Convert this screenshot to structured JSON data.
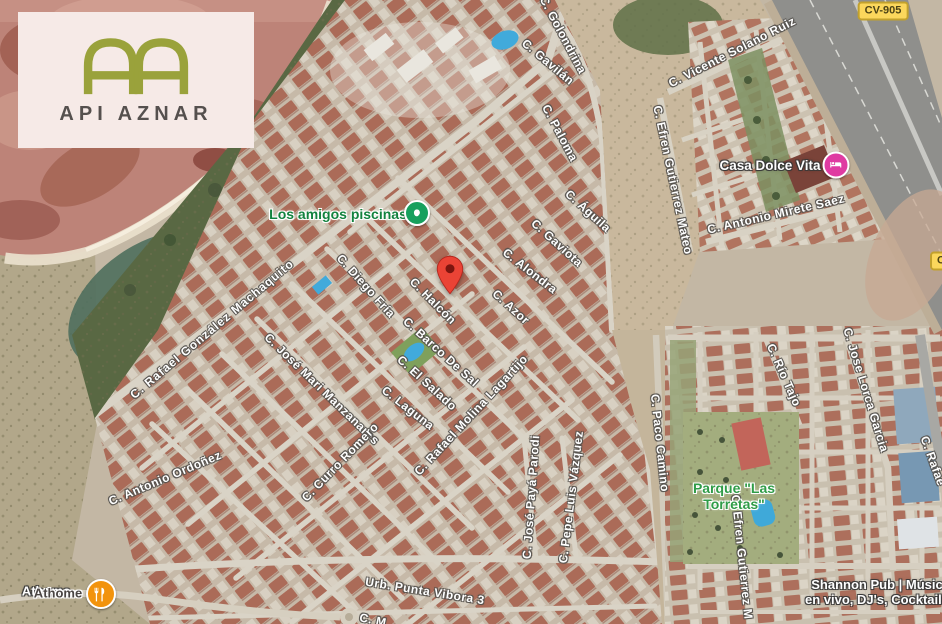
{
  "map_overlay": {
    "logo": {
      "monogram": "AA",
      "brand": "API AZNAR",
      "monogram_color": "#9aa23b",
      "card_color": "#f6eae7",
      "text_color": "#55504e"
    },
    "marker": {
      "name": "dropped-pin",
      "x": 450,
      "y": 296,
      "color": "#EA4335"
    },
    "road_badges": [
      {
        "label": "CV-905",
        "x": 883,
        "y": 11
      },
      {
        "label": "C",
        "x": 941,
        "y": 261
      }
    ],
    "street_labels": [
      {
        "label": "C. Golondrina",
        "x": 563,
        "y": 35,
        "rot": 62
      },
      {
        "label": "C. Gavilán",
        "x": 548,
        "y": 62,
        "rot": 40
      },
      {
        "label": "C. Paloma",
        "x": 560,
        "y": 133,
        "rot": 62
      },
      {
        "label": "C. Águila",
        "x": 588,
        "y": 211,
        "rot": 42
      },
      {
        "label": "C. Gaviota",
        "x": 557,
        "y": 243,
        "rot": 42
      },
      {
        "label": "C. Alondra",
        "x": 530,
        "y": 271,
        "rot": 38
      },
      {
        "label": "C. Azor",
        "x": 511,
        "y": 307,
        "rot": 42
      },
      {
        "label": "C. Halcón",
        "x": 433,
        "y": 301,
        "rot": 45
      },
      {
        "label": "C. Diego Fría",
        "x": 366,
        "y": 286,
        "rot": 48
      },
      {
        "label": "C. Barco De Sal",
        "x": 441,
        "y": 352,
        "rot": 42
      },
      {
        "label": "C. El Salado",
        "x": 427,
        "y": 383,
        "rot": 42
      },
      {
        "label": "C. Laguna",
        "x": 408,
        "y": 408,
        "rot": 38
      },
      {
        "label": "C. Rafael Molina Lagartijo",
        "x": 471,
        "y": 415,
        "rot": -47
      },
      {
        "label": "C. Rafael González Machaquito",
        "x": 212,
        "y": 329,
        "rot": -40,
        "spacing": 1.1
      },
      {
        "label": "C. José Mari Manzanares",
        "x": 322,
        "y": 389,
        "rot": 44
      },
      {
        "label": "C. Antonio Ordoñez",
        "x": 165,
        "y": 478,
        "rot": -23
      },
      {
        "label": "C. Curro Romero",
        "x": 340,
        "y": 462,
        "rot": -46
      },
      {
        "label": "C. José Payá Parodi",
        "x": 531,
        "y": 497,
        "rot": -86
      },
      {
        "label": "C. Pepe Luis Vázquez",
        "x": 571,
        "y": 497,
        "rot": -83
      },
      {
        "label": "C. Paco Camino",
        "x": 660,
        "y": 443,
        "rot": 84
      },
      {
        "label": "C. Efren Gutierrez Mateo",
        "x": 673,
        "y": 180,
        "rot": 78
      },
      {
        "label": "C. Efren Gutierrez M",
        "x": 742,
        "y": 557,
        "rot": 84
      },
      {
        "label": "C. Vicente Solano Ruiz",
        "x": 732,
        "y": 52,
        "rot": -27
      },
      {
        "label": "C. Antonio Mirete Saez",
        "x": 776,
        "y": 214,
        "rot": -13
      },
      {
        "label": "C. Río Tajo",
        "x": 784,
        "y": 375,
        "rot": 66
      },
      {
        "label": "C. Jose Lorca Garcia",
        "x": 866,
        "y": 390,
        "rot": 73
      },
      {
        "label": "C. Rafae",
        "x": 933,
        "y": 461,
        "rot": 70
      },
      {
        "label": "Urb. Punta Vibora 3",
        "x": 425,
        "y": 591,
        "rot": 9
      },
      {
        "label": "C. M",
        "x": 373,
        "y": 620,
        "rot": 12
      }
    ],
    "poi_labels": [
      {
        "lines": [
          "Los amigos piscinas"
        ],
        "x": 338,
        "y": 214,
        "halo": "light",
        "color": "#12823e",
        "size": 14,
        "icon": {
          "kind": "pool",
          "x": 417,
          "y": 213,
          "color": "#16a05d",
          "ring": true,
          "size": 22
        }
      },
      {
        "lines": [
          "Casa Dolce Vita"
        ],
        "x": 770,
        "y": 166,
        "halo": "dark",
        "color": "#ffffff",
        "size": 13.5,
        "icon": {
          "kind": "lodging",
          "x": 836,
          "y": 165,
          "color": "#df3ba2",
          "ring": true,
          "size": 23
        }
      },
      {
        "lines": [
          "Parque \"Las",
          "Torretas\""
        ],
        "x": 734,
        "y": 496,
        "halo": "light",
        "color": "#2f9c47",
        "size": 14
      },
      {
        "lines": [
          "Shannon Pub | Músic",
          "en vivo, DJ's, Cocktails"
        ],
        "x": 877,
        "y": 593,
        "halo": "dark",
        "color": "#ffffff",
        "size": 13
      },
      {
        "lines": [
          "Athome"
        ],
        "x": 46,
        "y": 592,
        "halo": "dark",
        "color": "#ffffff",
        "size": 13
      },
      {
        "lines": [
          "Athome"
        ],
        "x": 58,
        "y": 594,
        "halo": "light",
        "color": "#4a4543",
        "size": 13,
        "icon": {
          "kind": "restaurant",
          "x": 101,
          "y": 594,
          "color": "#f2930d",
          "ring": true,
          "size": 26
        }
      }
    ]
  }
}
